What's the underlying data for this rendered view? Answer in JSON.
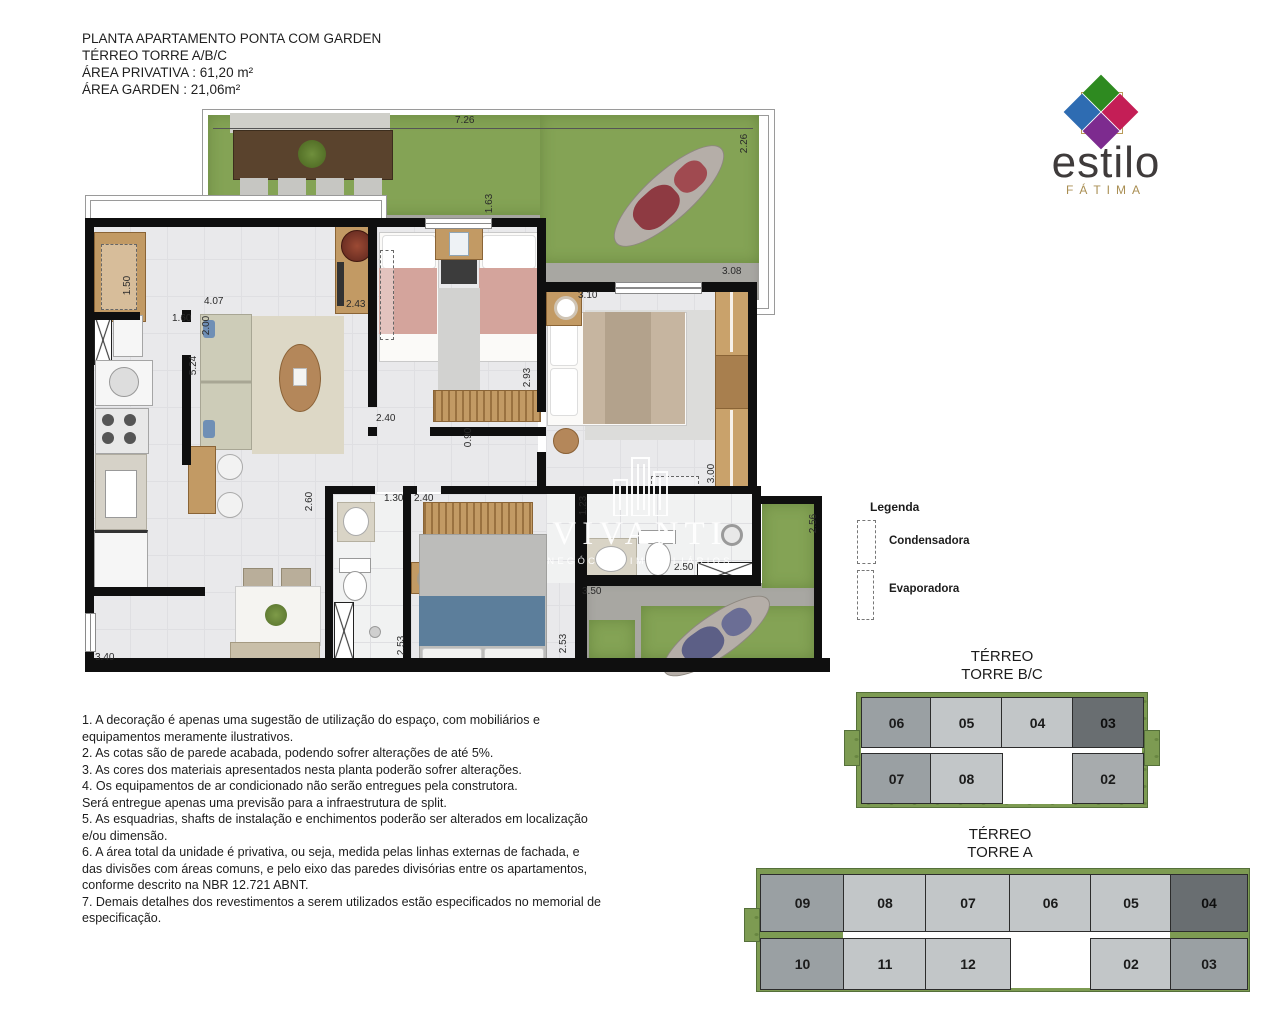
{
  "header": {
    "line1": "PLANTA  APARTAMENTO PONTA COM GARDEN",
    "line2": "TÉRREO TORRE A/B/C",
    "line3": "ÁREA PRIVATIVA : 61,20 m²",
    "line4": "ÁREA GARDEN : 21,06m²"
  },
  "brand": {
    "name": "estilo",
    "subname": "FÁTIMA",
    "colors": {
      "top": "#2e8a20",
      "left": "#2e6cb2",
      "right": "#c41e56",
      "bottom": "#7d2b8f",
      "frame": "#b99a58",
      "gold_text": "#a98e52"
    }
  },
  "watermark": {
    "name": "VIVANTI",
    "tagline": "NEGÓCIOS IMOBILIÁRIOS"
  },
  "legend": {
    "title": "Legenda",
    "items": [
      {
        "label": "Condensadora"
      },
      {
        "label": "Evaporadora"
      }
    ]
  },
  "dims": [
    "7.26",
    "2.26",
    "1.63",
    "3.08",
    "3.10",
    "4.07",
    "1.50",
    "1.60",
    "2.00",
    "5.24",
    "2.43",
    "2.40",
    "0.90",
    "2.93",
    "3.00",
    "2.60",
    "1.30",
    "2.40",
    "1.23",
    "2.50",
    "3.50",
    "2.53",
    "2.53",
    "3.40",
    "2.56"
  ],
  "keyplans": {
    "bc": {
      "title1": "TÉRREO",
      "title2": "TORRE B/C",
      "units": {
        "u06": "06",
        "u05": "05",
        "u04": "04",
        "u03": "03",
        "u07": "07",
        "u08": "08",
        "u02": "02"
      },
      "highlighted_unit": "03",
      "shade_colors": {
        "light": "#c2c6c8",
        "medium": "#9aa0a3",
        "dark": "#696e71",
        "grass": "#7d9b52"
      }
    },
    "a": {
      "title1": "TÉRREO",
      "title2": "TORRE A",
      "units": {
        "u09": "09",
        "u08": "08",
        "u07": "07",
        "u06": "06",
        "u05": "05",
        "u04": "04",
        "u10": "10",
        "u11": "11",
        "u12": "12",
        "u02": "02",
        "u03": "03"
      },
      "highlighted_unit": "04"
    }
  },
  "notes": "1. A decoração é apenas uma sugestão de utilização do espaço, com mobiliários e\n equipamentos meramente ilustrativos.\n2. As cotas são de parede acabada, podendo sofrer alterações de até 5%.\n3. As cores dos materiais apresentados nesta planta poderão sofrer alterações.\n4. Os equipamentos de ar condicionado não serão entregues pela construtora.\nSerá entregue apenas uma previsão para a infraestrutura de split.\n5. As esquadrias, shafts de instalação e enchimentos poderão ser alterados em localização\ne/ou dimensão.\n6. A área total da unidade é privativa, ou seja, medida pelas linhas externas de fachada, e\n das divisões com áreas comuns, e pelo eixo das paredes divisórias entre os apartamentos,\n conforme descrito na NBR 12.721 ABNT.\n7. Demais detalhes dos revestimentos a serem utilizados estão especificados no memorial de\nespecificação."
}
